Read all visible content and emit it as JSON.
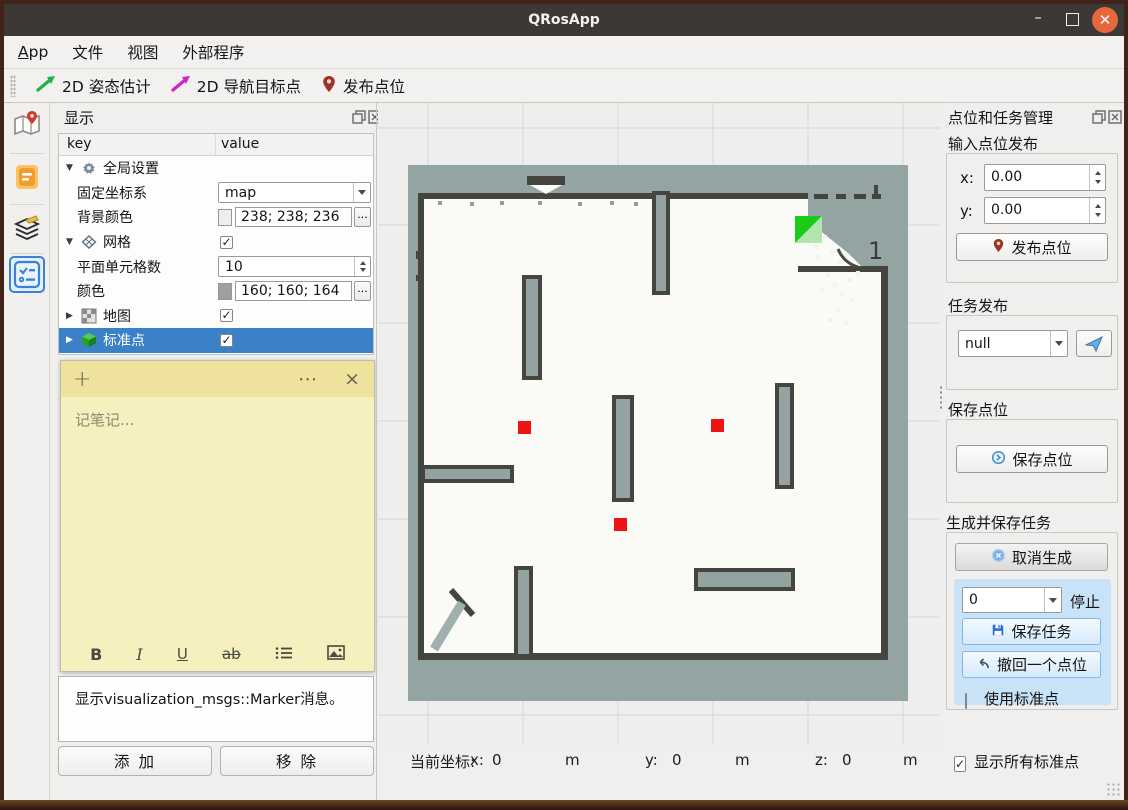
{
  "window": {
    "title": "QRosApp"
  },
  "menu": {
    "items": [
      "App",
      "文件",
      "视图",
      "外部程序"
    ]
  },
  "toolbar": {
    "pose_estimate": "2D 姿态估计",
    "nav_goal": "2D 导航目标点",
    "publish_point": "发布点位"
  },
  "display_panel": {
    "title": "显示",
    "header": {
      "key": "key",
      "value": "value"
    },
    "rows": [
      {
        "key": "全局设置",
        "expander": "▼"
      },
      {
        "key": "固定坐标系",
        "value": "map"
      },
      {
        "key": "背景颜色",
        "value": "238; 238; 236",
        "swatch": "#eeeeec",
        "swatch_style": "background:#eeeeec",
        "more": "..."
      },
      {
        "key": "网格",
        "expander": "▼",
        "check": "✓"
      },
      {
        "key": "平面单元格数",
        "value": "10"
      },
      {
        "key": "颜色",
        "value": "160; 160; 164",
        "swatch": "#a0a0a4",
        "swatch_style": "background:#a0a0a4",
        "more": "..."
      },
      {
        "key": "地图",
        "expander": "▶",
        "check": "✓"
      },
      {
        "key": "标准点",
        "expander": "▶",
        "check": "✓"
      }
    ],
    "note": {
      "add": "+",
      "menu": "⋯",
      "close": "×",
      "placeholder": "记笔记...",
      "bold": "B",
      "italic": "I",
      "underline": "U",
      "strike": "ab"
    },
    "description": "显示visualization_msgs::Marker消息。",
    "add_button": "添  加",
    "remove_button": "移  除"
  },
  "map_view": {
    "robot_label": "1",
    "status": {
      "prefix": "当前坐标:",
      "x_label": "x:",
      "x_value": "0",
      "y_label": "y:",
      "y_value": "0",
      "z_label": "z:",
      "z_value": "0",
      "unit": "m"
    }
  },
  "task_panel": {
    "title": "点位和任务管理",
    "input_publish": {
      "label": "输入点位发布",
      "x_label": "x:",
      "x_value": "0.00",
      "y_label": "y:",
      "y_value": "0.00",
      "publish_button": "发布点位"
    },
    "task_publish": {
      "label": "任务发布",
      "selected_option": "null"
    },
    "save_point": {
      "label": "保存点位",
      "button": "保存点位"
    },
    "generate": {
      "label": "生成并保存任务",
      "cancel_button": "取消生成",
      "count_value": "0",
      "stop_label": "停止",
      "save_button": "保存任务",
      "undo_button": "撤回一个点位",
      "use_std_label": "使用标准点"
    },
    "show_all_label": "显示所有标准点",
    "show_all_check": "✓"
  },
  "colors": {
    "accent_blue": "#3a81c8",
    "titlebar": "#3b3836",
    "close_orange": "#e8663c",
    "note_header": "#efe29c",
    "note_body": "#f6efbe",
    "map_background": "#eeeeec",
    "map_unknown": "#94a4a3",
    "map_free": "#fafaf6",
    "map_wall": "#45453f",
    "marker_red": "#ee1414",
    "robot_green": "#1bcb1b",
    "task_box_blue": "#c8e2f7",
    "background_color_value": "#eeeeec",
    "grid_color_value": "#a0a0a4"
  }
}
